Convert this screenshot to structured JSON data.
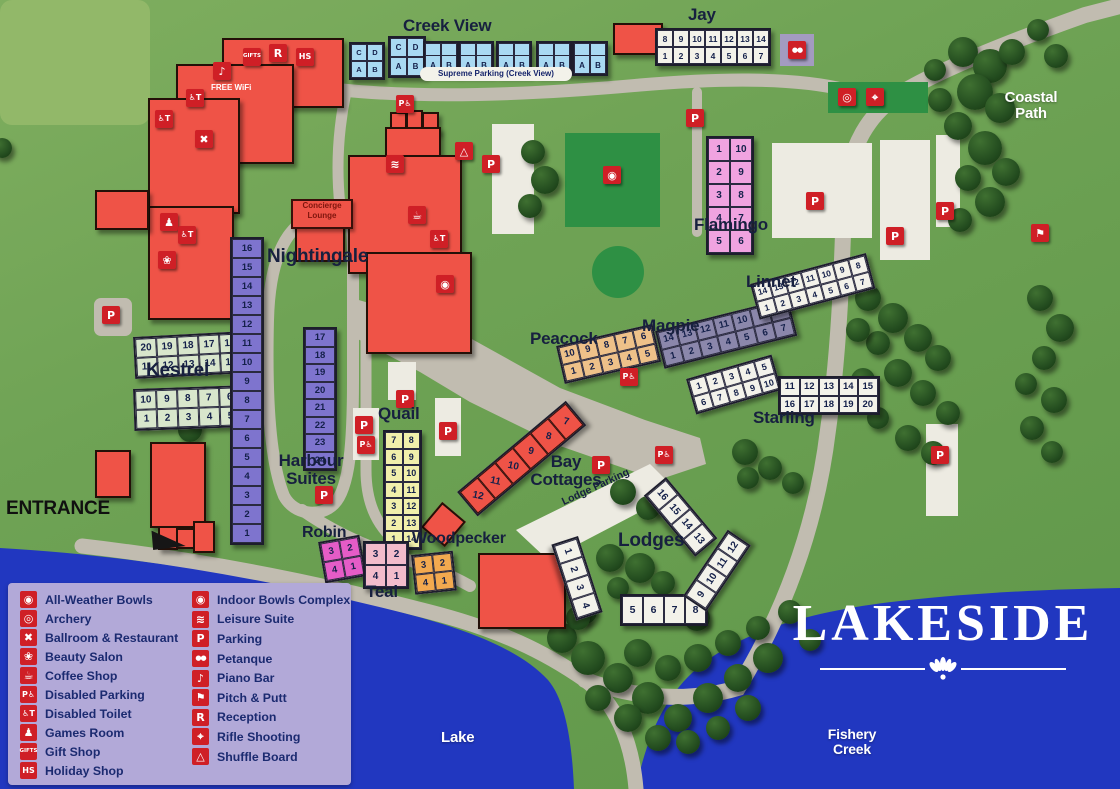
{
  "title": "LAKESIDE",
  "colors": {
    "water": "#2137c0",
    "road": "#c1bcb0",
    "building": "#ef5347",
    "icon_red": "#cf1f26",
    "legend_bg": "#b2a9d8",
    "legend_text": "#1b2a70",
    "pitch": "#2e9044",
    "creek_blue": "#a9d9f2",
    "harbour_purple": "#7e74ce",
    "flamingo_pink": "#f0a3e0"
  },
  "icons": {
    "all_weather_bowls": "◉",
    "archery": "◎",
    "ballroom": "✖",
    "beauty_salon": "❀",
    "coffee_shop": "☕",
    "disabled_parking": "P♿",
    "disabled_toilet": "♿T",
    "games_room": "♟",
    "gift_shop": "GIFTS",
    "holiday_shop": "HS",
    "indoor_bowls": "◉",
    "leisure_suite": "≋",
    "parking": "P",
    "petanque": "●●",
    "piano_bar": "♪",
    "pitch_putt": "⚑",
    "reception": "R",
    "rifle_shooting": "⌖",
    "shuffle_board": "△"
  },
  "legend": {
    "col1": [
      {
        "icon": "all_weather_bowls",
        "label": "All-Weather Bowls"
      },
      {
        "icon": "archery",
        "label": "Archery"
      },
      {
        "icon": "ballroom",
        "label": "Ballroom & Restaurant"
      },
      {
        "icon": "beauty_salon",
        "label": "Beauty Salon"
      },
      {
        "icon": "coffee_shop",
        "label": "Coffee Shop"
      },
      {
        "icon": "disabled_parking",
        "label": "Disabled Parking",
        "cls": "t8"
      },
      {
        "icon": "disabled_toilet",
        "label": "Disabled Toilet",
        "cls": "t8"
      },
      {
        "icon": "games_room",
        "label": "Games Room"
      },
      {
        "icon": "gift_shop",
        "label": "Gift Shop",
        "cls": "t5"
      },
      {
        "icon": "holiday_shop",
        "label": "Holiday Shop",
        "cls": "t8"
      }
    ],
    "col2": [
      {
        "icon": "indoor_bowls",
        "label": "Indoor Bowls Complex"
      },
      {
        "icon": "leisure_suite",
        "label": "Leisure Suite"
      },
      {
        "icon": "parking",
        "label": "Parking"
      },
      {
        "icon": "petanque",
        "label": "Petanque",
        "cls": "t7"
      },
      {
        "icon": "piano_bar",
        "label": "Piano Bar"
      },
      {
        "icon": "pitch_putt",
        "label": "Pitch & Putt"
      },
      {
        "icon": "reception",
        "label": "Reception"
      },
      {
        "icon": "rifle_shooting",
        "label": "Rifle Shooting"
      },
      {
        "icon": "shuffle_board",
        "label": "Shuffle Board"
      }
    ]
  },
  "labels": {
    "creek_view": "Creek View",
    "jay": "Jay",
    "flamingo": "Flamingo",
    "linnet": "Linnet",
    "magpie": "Magpie",
    "starling": "Starling",
    "peacock": "Peacock",
    "kestrel": "Kestrel",
    "nightingale": "Nightingale",
    "harbour1": "Harbour",
    "harbour2": "Suites",
    "quail": "Quail",
    "robin": "Robin",
    "teal": "Teal",
    "woodpecker": "Woodpecker",
    "bay1": "Bay",
    "bay2": "Cottages",
    "lodges": "Lodges",
    "entrance": "ENTRANCE",
    "lake": "Lake",
    "fishery1": "Fishery",
    "fishery2": "Creek",
    "coastal1": "Coastal",
    "coastal2": "Path",
    "concierge1": "Concierge",
    "concierge2": "Lounge",
    "supreme_parking": "Supreme Parking (Creek View)",
    "lodge_parking": "Lodge Parking",
    "free_wifi": "FREE WiFi"
  },
  "blocks": {
    "creek_a": {
      "rows": [
        [
          "C",
          "D"
        ],
        [
          "A",
          "B"
        ]
      ]
    },
    "creek_b": {
      "rows": [
        [
          "C",
          "D"
        ],
        [
          "A",
          "B"
        ]
      ]
    },
    "creek_p1": {
      "rows": [
        [
          "A",
          "B"
        ]
      ]
    },
    "creek_p2": {
      "rows": [
        [
          "A",
          "B"
        ]
      ]
    },
    "creek_p3": {
      "rows": [
        [
          "A",
          "B"
        ]
      ]
    },
    "creek_p4": {
      "rows": [
        [
          "A",
          "B"
        ]
      ]
    },
    "creek_p5": {
      "rows": [
        [
          "A",
          "B"
        ]
      ]
    },
    "jay": {
      "rows": [
        [
          "8",
          "9",
          "10",
          "11",
          "12",
          "13",
          "14"
        ],
        [
          "1",
          "2",
          "3",
          "4",
          "5",
          "6",
          "7"
        ]
      ]
    },
    "flamingo": {
      "rows": [
        [
          "1",
          "10"
        ],
        [
          "2",
          "9"
        ],
        [
          "3",
          "8"
        ],
        [
          "4",
          "7"
        ],
        [
          "5",
          "6"
        ]
      ]
    },
    "kestrel_upper": {
      "rows": [
        [
          "20",
          "19",
          "18",
          "17",
          "16"
        ],
        [
          "11",
          "12",
          "13",
          "14",
          "15"
        ]
      ]
    },
    "kestrel_lower": {
      "rows": [
        [
          "10",
          "9",
          "8",
          "7",
          "6"
        ],
        [
          "1",
          "2",
          "3",
          "4",
          "5"
        ]
      ]
    },
    "harbour_left": {
      "rows": [
        [
          "16"
        ],
        [
          "15"
        ],
        [
          "14"
        ],
        [
          "13"
        ],
        [
          "12"
        ],
        [
          "11"
        ],
        [
          "10"
        ],
        [
          "9"
        ],
        [
          "8"
        ],
        [
          "7"
        ],
        [
          "6"
        ],
        [
          "5"
        ],
        [
          "4"
        ],
        [
          "3"
        ],
        [
          "2"
        ],
        [
          "1"
        ]
      ]
    },
    "harbour_right": {
      "rows": [
        [
          "17"
        ],
        [
          "18"
        ],
        [
          "19"
        ],
        [
          "20"
        ],
        [
          "21"
        ],
        [
          "22"
        ],
        [
          "23"
        ],
        [
          "24"
        ]
      ]
    },
    "quail": {
      "rows": [
        [
          "7",
          "8"
        ],
        [
          "6",
          "9"
        ],
        [
          "5",
          "10"
        ],
        [
          "4",
          "11"
        ],
        [
          "3",
          "12"
        ],
        [
          "2",
          "13"
        ],
        [
          "1",
          "14"
        ]
      ]
    },
    "robin": {
      "rows": [
        [
          "3",
          "2"
        ],
        [
          "4",
          "1"
        ]
      ]
    },
    "teal": {
      "rows": [
        [
          "3",
          "2"
        ],
        [
          "4",
          "1"
        ]
      ]
    },
    "woodpecker": {
      "rows": [
        [
          "3",
          "2"
        ],
        [
          "4",
          "1"
        ]
      ]
    },
    "peacock": {
      "rows": [
        [
          "10",
          "9",
          "8",
          "7",
          "6"
        ],
        [
          "1",
          "2",
          "3",
          "4",
          "5"
        ]
      ]
    },
    "magpie": {
      "rows": [
        [
          "14",
          "13",
          "12",
          "11",
          "10",
          "9",
          "8"
        ],
        [
          "1",
          "2",
          "3",
          "4",
          "5",
          "6",
          "7"
        ]
      ]
    },
    "linnet": {
      "rows": [
        [
          "14",
          "13",
          "12",
          "11",
          "10",
          "9",
          "8"
        ],
        [
          "1",
          "2",
          "3",
          "4",
          "5",
          "6",
          "7"
        ]
      ]
    },
    "starling_a": {
      "rows": [
        [
          "1",
          "2",
          "3",
          "4",
          "5"
        ],
        [
          "6",
          "7",
          "8",
          "9",
          "10"
        ]
      ]
    },
    "starling_b": {
      "rows": [
        [
          "11",
          "12",
          "13",
          "14",
          "15"
        ],
        [
          "16",
          "17",
          "18",
          "19",
          "20"
        ]
      ]
    },
    "bay_cottages": {
      "rows": [
        [
          "12",
          "11",
          "10",
          "9",
          "8",
          "7"
        ]
      ]
    },
    "lodges_a": {
      "rows": [
        [
          "16",
          "15",
          "14",
          "13"
        ]
      ]
    },
    "lodges_b": {
      "rows": [
        [
          "1",
          "2",
          "3",
          "4"
        ]
      ]
    },
    "lodges_c": {
      "rows": [
        [
          "5",
          "6",
          "7",
          "8"
        ]
      ]
    },
    "lodges_d": {
      "rows": [
        [
          "9",
          "10",
          "11",
          "12"
        ]
      ]
    }
  }
}
